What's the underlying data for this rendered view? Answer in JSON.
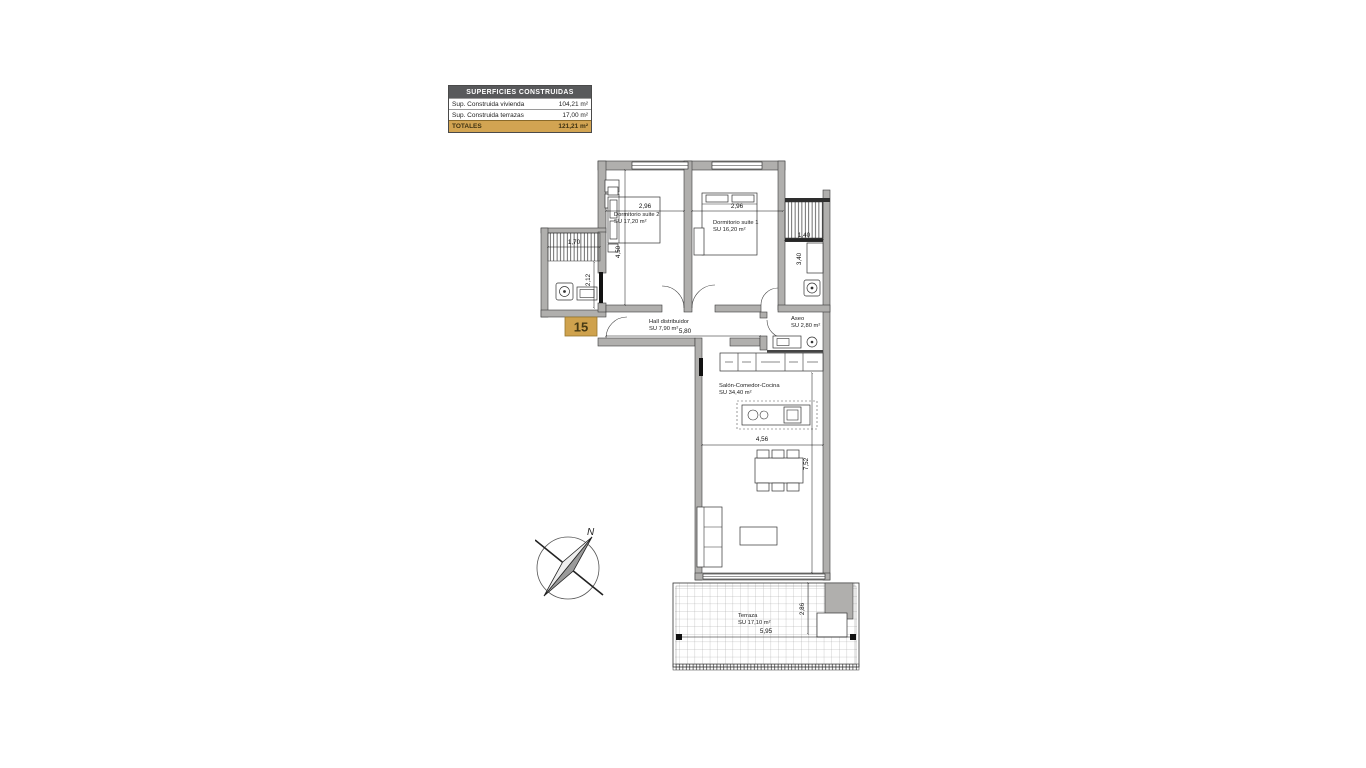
{
  "summary_table": {
    "header": "SUPERFICIES CONSTRUIDAS",
    "rows": [
      {
        "label": "Sup. Construida vivienda",
        "value": "104,21 m²"
      },
      {
        "label": "Sup. Construida terrazas",
        "value": "17,00 m²"
      }
    ],
    "total_row": {
      "label": "TOTALES",
      "value": "121,21 m²"
    }
  },
  "plan": {
    "unit_number": "15",
    "compass_north": "N",
    "rooms": {
      "dormitorio_suite_2": {
        "name": "Dormitorio suite 2",
        "area": "SU  17,20 m²"
      },
      "dormitorio_suite_1": {
        "name": "Dormitorio suite 1",
        "area": "SU  16,20 m²"
      },
      "hall": {
        "name": "Hall distribuidor",
        "area": "SU  7,90 m²"
      },
      "aseo": {
        "name": "Aseo",
        "area": "SU  2,80 m²"
      },
      "salon": {
        "name": "Salón-Comedor-Cocina",
        "area": "SU  34,40 m²"
      },
      "terraza": {
        "name": "Terraza",
        "area": "SU  17,10 m²"
      }
    },
    "dimensions": {
      "bed2_width": "2,96",
      "bed1_width": "2,96",
      "bed2_height": "4,50",
      "balcony_left_width": "1,70",
      "bath_left_height": "2,12",
      "balcony_right_width": "1,40",
      "bath_right_height": "3,40",
      "hall_width": "5,80",
      "salon_width": "4,56",
      "salon_height": "7,52",
      "terrace_width": "5,95",
      "terrace_height": "2,86"
    }
  },
  "colors": {
    "wall": "#b0afad",
    "accent_gold": "#d2a452",
    "table_header_bg": "#58595b",
    "line": "#1a1a1a"
  }
}
